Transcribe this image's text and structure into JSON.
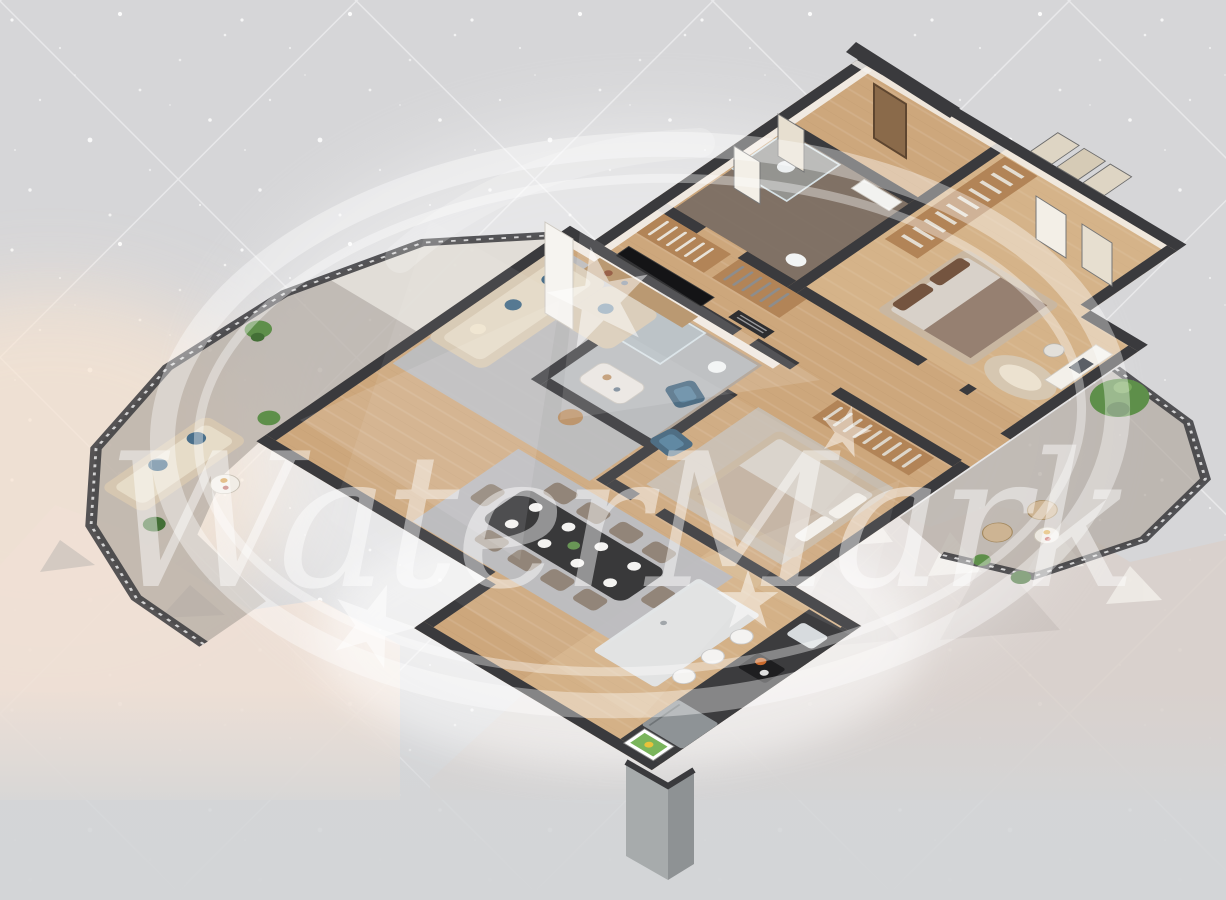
{
  "watermark": {
    "text": "WaterMark",
    "elements": [
      "double-ellipse-swoosh",
      "five-point-stars",
      "script-text"
    ]
  },
  "scene": {
    "type": "isometric-3d-floor-plan-render",
    "description": "Cutaway 3D render of a furnished apartment viewed from above at an angle, over a gray diamond-grid backdrop with snow speckles and a faint mountain ridge",
    "rooms": [
      {
        "name": "entry-hall",
        "items": [
          "entrance-door"
        ]
      },
      {
        "name": "shower-bathroom",
        "items": [
          "walk-in-shower",
          "toilet",
          "vanity"
        ]
      },
      {
        "name": "master-bedroom",
        "items": [
          "double-bed-brown-pillows",
          "open-wardrobe",
          "curved-lounge-sofa",
          "desk-with-laptop",
          "desk-chair",
          "three-panel-wall-art"
        ]
      },
      {
        "name": "hallway",
        "items": [
          "built-in-closets",
          "wall-mirrors"
        ]
      },
      {
        "name": "second-bedroom",
        "items": [
          "double-bed",
          "open-closet",
          "area-rug"
        ]
      },
      {
        "name": "second-bathroom",
        "items": [
          "shower",
          "sink",
          "toilet"
        ]
      },
      {
        "name": "living-room",
        "items": [
          "l-shaped-beige-sofa",
          "blue-accent-pillows",
          "two-blue-armchairs",
          "coffee-table",
          "side-table",
          "tv",
          "media-console",
          "air-conditioner",
          "gray-area-rug"
        ]
      },
      {
        "name": "dining-area",
        "items": [
          "dark-dining-table",
          "eight-chairs",
          "place-settings",
          "centerpiece-plant"
        ]
      },
      {
        "name": "kitchen",
        "items": [
          "island-with-bar-stools",
          "dark-counter-run",
          "sink",
          "stove-with-pot",
          "fridge",
          "leaning-framed-picture"
        ]
      },
      {
        "name": "left-terrace",
        "items": [
          "chevron-railing",
          "outdoor-sofa-blue-pillows",
          "round-table-with-fruit",
          "potted-plants",
          "concrete-deck"
        ]
      },
      {
        "name": "right-balcony",
        "items": [
          "chevron-railing",
          "green-shrub",
          "two-wicker-chairs",
          "round-table-with-fruit",
          "potted-plants"
        ]
      }
    ],
    "environment": {
      "background": "light gray with diagonal diamond grid and white snow speckles",
      "backdrop": "snowy mountain ridge fading into gray at the bottom",
      "lighting": "soft white glow around the apartment, warm sunset glow at lower left"
    }
  },
  "colors": {
    "background": "#d6d6d8",
    "background_bottom": "#d3d5d7",
    "grid_line": "#ffffff",
    "speckle": "#ffffff",
    "wall": "#3a3a3d",
    "wall_light": "#f4f1ec",
    "wood": "#cda77c",
    "wood_light": "#e6cba2",
    "rug": "#b7bac0",
    "sofa": "#d6c7b1",
    "pillow_blue": "#4a6f8a",
    "chair_taupe": "#8a7c6f",
    "table_dark": "#2a2a2c",
    "island_top": "#e2e5e7",
    "counter": "#3c3c3e",
    "steel": "#8e9396",
    "bed_frame": "#c9b7a1",
    "duvet": "#d8d1c9",
    "pillow_brown": "#74543f",
    "closet": "#b28457",
    "terrace": "#b3aba2",
    "terrace_light": "#e9e6e0",
    "marble_dark": "#7a6d63",
    "marble_mid": "#a99d92",
    "plant": "#5e8f4a",
    "plant_dark": "#436f36",
    "door": "#8a6a4a",
    "pillar": "#a7abac",
    "mountain_light": "#efe0d5",
    "mountain_mid": "#d9d0cb",
    "mountain_shadow": "#c2bab6",
    "glow_warm": "#f7e4d2",
    "watermark": "#ffffff"
  }
}
